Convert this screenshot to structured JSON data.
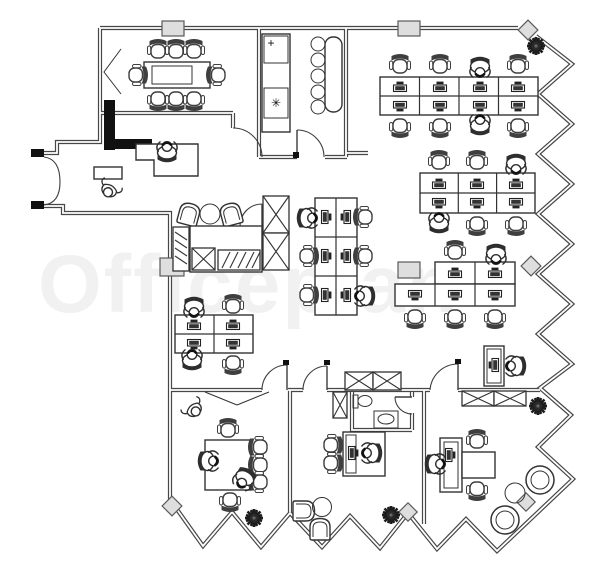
{
  "watermark": {
    "text": "Officeplan",
    "color": "#f1f1f1"
  },
  "kitchen": {
    "fridge_symbol": "+",
    "appliance_symbol": "✳"
  },
  "colors": {
    "ink": "#333333",
    "wall": "#474747",
    "black_wall": "#111111",
    "column_fill": "#dedede",
    "watermark": "#f1f1f1",
    "background": "#ffffff"
  }
}
